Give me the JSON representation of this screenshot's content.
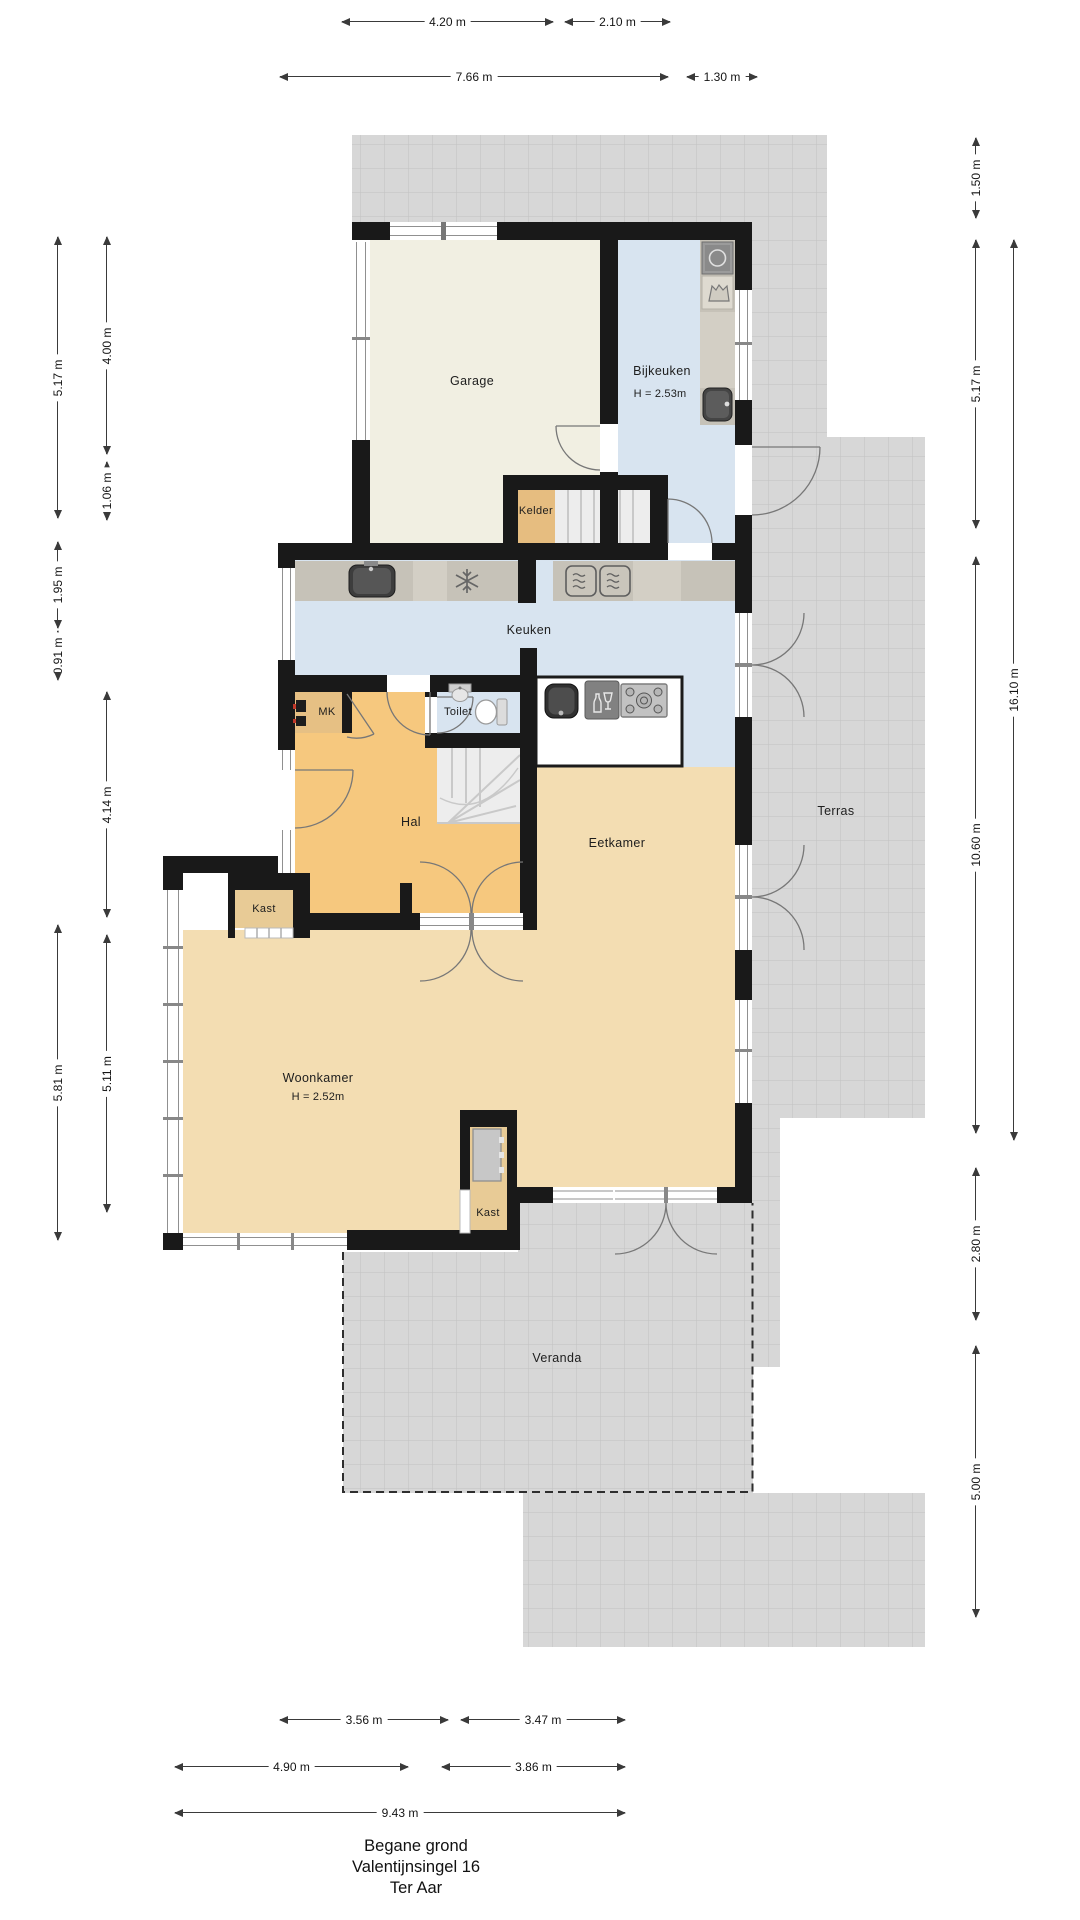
{
  "title": {
    "line1": "Begane grond",
    "line2": "Valentijnsingel 16",
    "line3": "Ter Aar"
  },
  "rooms": {
    "garage": {
      "label": "Garage"
    },
    "bijkeuken": {
      "label": "Bijkeuken",
      "height": "H = 2.53m"
    },
    "kelder": {
      "label": "Kelder"
    },
    "keuken": {
      "label": "Keuken"
    },
    "mk": {
      "label": "MK"
    },
    "toilet": {
      "label": "Toilet"
    },
    "hal": {
      "label": "Hal"
    },
    "eetkamer": {
      "label": "Eetkamer"
    },
    "woonkamer": {
      "label": "Woonkamer",
      "height": "H = 2.52m"
    },
    "kast_hal": {
      "label": "Kast"
    },
    "kast_eetkamer": {
      "label": "Kast"
    },
    "terras": {
      "label": "Terras"
    },
    "veranda": {
      "label": "Veranda"
    }
  },
  "dimensions": {
    "top": [
      {
        "label": "4.20 m"
      },
      {
        "label": "2.10 m"
      },
      {
        "label": "7.66 m"
      },
      {
        "label": "1.30 m"
      }
    ],
    "bottom": [
      {
        "label": "3.56 m"
      },
      {
        "label": "3.47 m"
      },
      {
        "label": "4.90 m"
      },
      {
        "label": "3.86 m"
      },
      {
        "label": "9.43 m"
      }
    ],
    "left": [
      {
        "label": "5.17 m"
      },
      {
        "label": "4.00 m"
      },
      {
        "label": "1.06 m"
      },
      {
        "label": "1.95 m"
      },
      {
        "label": "0.91 m"
      },
      {
        "label": "4.14 m"
      },
      {
        "label": "5.81 m"
      },
      {
        "label": "5.11 m"
      }
    ],
    "right": [
      {
        "label": "1.50 m"
      },
      {
        "label": "5.17 m"
      },
      {
        "label": "16.10 m"
      },
      {
        "label": "10.60 m"
      },
      {
        "label": "2.80 m"
      },
      {
        "label": "5.00 m"
      }
    ]
  },
  "colors": {
    "wall": "#191919",
    "garage_floor": "#f1efe2",
    "kitchen_blue": "#d8e4f0",
    "hal_orange": "#f6c87e",
    "living_tan": "#f3ddb2",
    "closet_tan": "#e8cb96",
    "cellar_tan": "#e6bd80",
    "tile_grey": "#d7d7d7",
    "counter_grey": "#c6c2b8",
    "island_white": "#ffffff"
  },
  "icons": {
    "washing_machine": "square with drum circle",
    "laundry_basket": "basket glyph",
    "utility_sink": "dark basin with faucet",
    "kitchen_sink": "dark basin with faucet",
    "freezer": "snowflake",
    "oven": "square with steam waves (x2)",
    "island_sink": "dark basin",
    "dishwasher": "grey square with glass and bottle",
    "gas_hob": "five burner hob",
    "hand_basin": "small basin",
    "toilet_bowl": "bowl with cistern",
    "meter_cabinet": "meter boxes",
    "winder_stairs": "fanned staircase",
    "cellar_stairs": "straight flight"
  }
}
